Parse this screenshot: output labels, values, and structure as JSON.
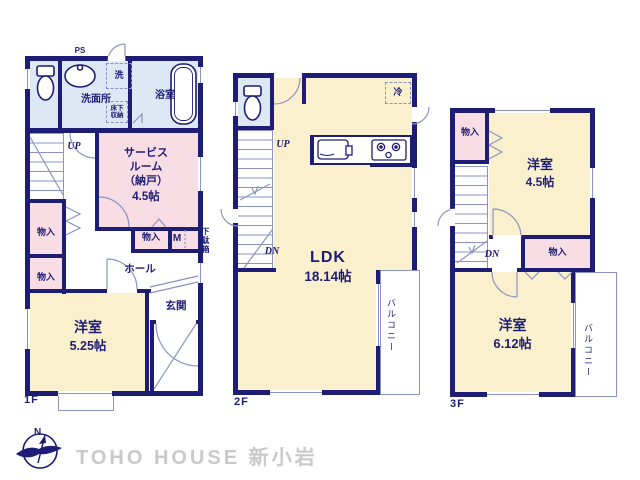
{
  "colors": {
    "wall": "#1d1d75",
    "pink": "#f8dee4",
    "yellow": "#fbf0cd",
    "blue": "#dce8f4",
    "thin": "#8a93c4",
    "brand": "#c9c9c9"
  },
  "floor1": {
    "label": "1F",
    "ps_label": "PS",
    "washroom": "洗面所",
    "washer": "洗",
    "underfloor_storage": "床下\n収納",
    "bathroom": "浴室",
    "up_label": "UP",
    "service_room": "サービス\nルーム\n（納戸）",
    "service_room_size": "4.5帖",
    "closet_a": "物入",
    "closet_b": "物入",
    "closet_c": "物入",
    "m_label": "M",
    "shoe_cabinet": "下駄箱",
    "hall": "ホール",
    "entrance": "玄関",
    "bedroom": "洋室",
    "bedroom_size": "5.25帖"
  },
  "floor2": {
    "label": "2F",
    "up_label": "UP",
    "dn_label": "DN",
    "refrigerator": "冷",
    "ldk": "LDK",
    "ldk_size": "18.14帖",
    "balcony": "バルコニー"
  },
  "floor3": {
    "label": "3F",
    "dn_label": "DN",
    "closet_a": "物入",
    "closet_b": "物入",
    "bedroom_a": "洋室",
    "bedroom_a_size": "4.5帖",
    "bedroom_b": "洋室",
    "bedroom_b_size": "6.12帖",
    "balcony": "バルコニー"
  },
  "footer": {
    "compass_north": "N",
    "brand": "TOHO HOUSE 新小岩"
  }
}
